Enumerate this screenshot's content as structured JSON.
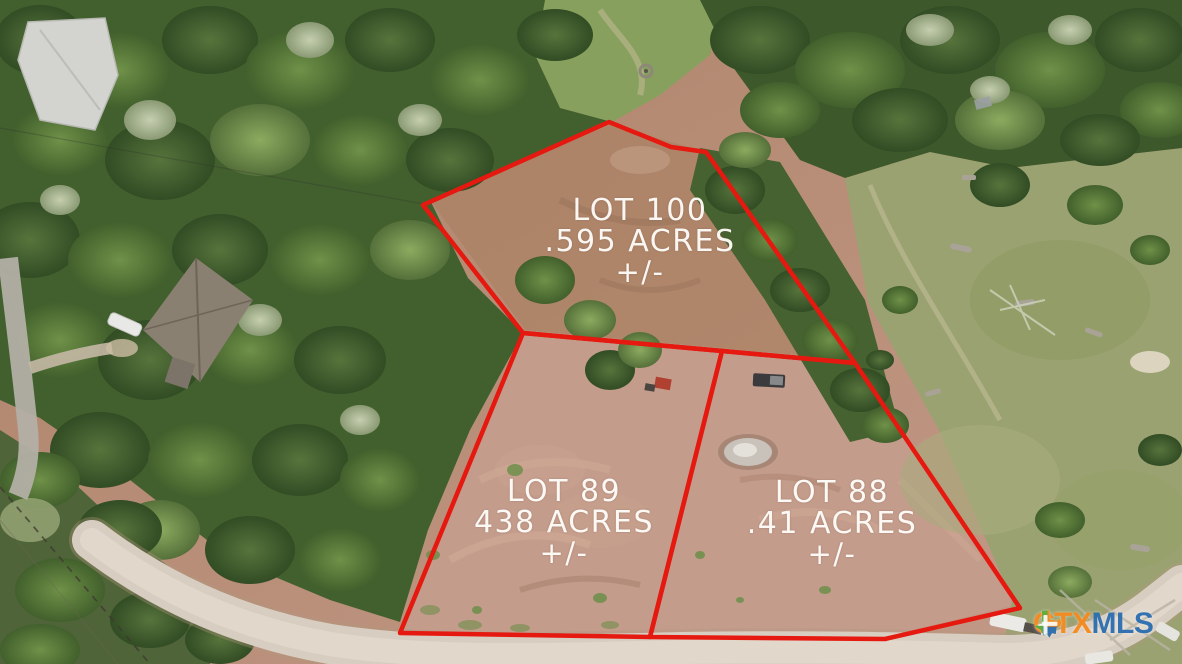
{
  "lots": [
    {
      "name": "LOT 100",
      "acreage": ".595 ACRES",
      "tolerance": "+/-"
    },
    {
      "name": "LOT 89",
      "acreage": "438 ACRES",
      "tolerance": "+/-"
    },
    {
      "name": "LOT 88",
      "acreage": ".41 ACRES",
      "tolerance": "+/-"
    }
  ],
  "watermark": {
    "prefix": "CTX",
    "suffix": "MLS",
    "prefix_color": "#f68b1f",
    "suffix_color": "#2d6fb0",
    "icon": "texas-state-icon"
  },
  "overlay": {
    "boundary_color": "#e5190f",
    "label_color": "#ffffff"
  }
}
